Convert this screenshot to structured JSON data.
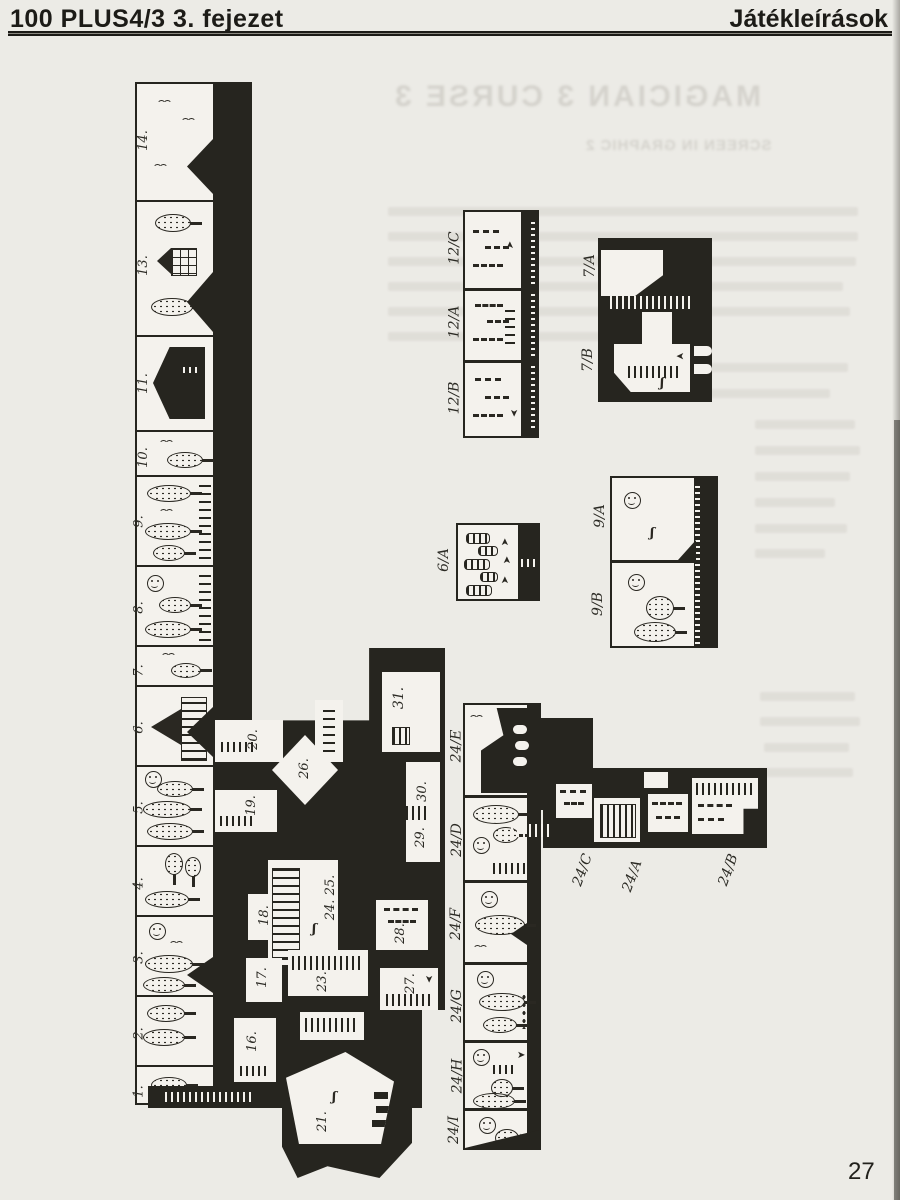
{
  "page": {
    "header_left": "100 PLUS4/3  3. fejezet",
    "header_right": "Játékleírások",
    "page_number": "27"
  },
  "ghost": {
    "title_mirrored": "MAGICIAN 3 CURSE 3",
    "subtitle_mirrored": "SCREEN IN GRAPHIC 2"
  },
  "icons": {
    "arrow": "➤",
    "figure": "ʃ"
  },
  "map": {
    "left_cells": [
      {
        "label": "14."
      },
      {
        "label": "13."
      },
      {
        "label": "11."
      },
      {
        "label": "10."
      },
      {
        "label": "9."
      },
      {
        "label": "8."
      },
      {
        "label": "7."
      },
      {
        "label": "6."
      },
      {
        "label": "5."
      },
      {
        "label": "4."
      },
      {
        "label": "3."
      },
      {
        "label": "2."
      },
      {
        "label": "1."
      }
    ],
    "central": {
      "r31": "31.",
      "r30": "30.",
      "r29": "29.",
      "r26": "26.",
      "r20": "20.",
      "r19": "19.",
      "r18": "18.",
      "r2425": "24. 25.",
      "r17": "17.",
      "r23": "23.",
      "r28": "28.",
      "r27": "27.",
      "r16": "16.",
      "r21": "21."
    },
    "strip12": [
      "12/C",
      "12/A",
      "12/B"
    ],
    "block7": [
      "7/A",
      "7/B"
    ],
    "block6": [
      "6/A"
    ],
    "block9": [
      "9/A",
      "9/B"
    ],
    "strip24": [
      "24/E",
      "24/D",
      "24/F",
      "24/G",
      "24/H",
      "24/I"
    ],
    "arm24": [
      "24/C",
      "24/A",
      "24/B"
    ]
  }
}
